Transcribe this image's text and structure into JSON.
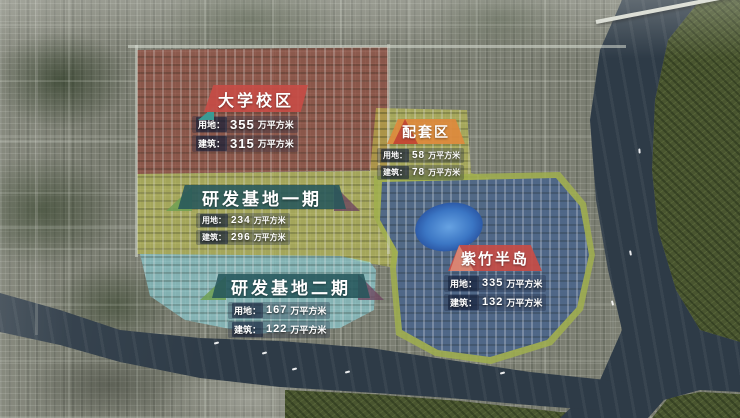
{
  "map": {
    "regions": [
      {
        "name": "大学校区",
        "zone_color": "#963a2c",
        "banner_color": "#c64c46",
        "land_label": "用地：",
        "land_value": "355",
        "land_unit": "万平方米",
        "building_label": "建筑：",
        "building_value": "315",
        "building_unit": "万平方米"
      },
      {
        "name": "配套区",
        "zone_color": "#c6c648",
        "banner_color": "#de8a3c",
        "land_label": "用地：",
        "land_value": "58",
        "land_unit": "万平方米",
        "building_label": "建筑：",
        "building_value": "78",
        "building_unit": "万平方米"
      },
      {
        "name": "研发基地一期",
        "zone_color": "#c6c648",
        "banner_color": "#25575b",
        "land_label": "用地：",
        "land_value": "234",
        "land_unit": "万平方米",
        "building_label": "建筑：",
        "building_value": "296",
        "building_unit": "万平方米"
      },
      {
        "name": "研发基地二期",
        "zone_color": "#8ad6e0",
        "banner_color": "#25575b",
        "land_label": "用地：",
        "land_value": "167",
        "land_unit": "万平方米",
        "building_label": "建筑：",
        "building_value": "122",
        "building_unit": "万平方米"
      },
      {
        "name": "紫竹半岛",
        "zone_color": "#2c48a0",
        "banner_color": "#c64c46",
        "land_label": "用地：",
        "land_value": "335",
        "land_unit": "万平方米",
        "building_label": "建筑：",
        "building_value": "132",
        "building_unit": "万平方米"
      }
    ],
    "water_color": "#2e3b47",
    "greenbelt_color": "#49552f"
  }
}
